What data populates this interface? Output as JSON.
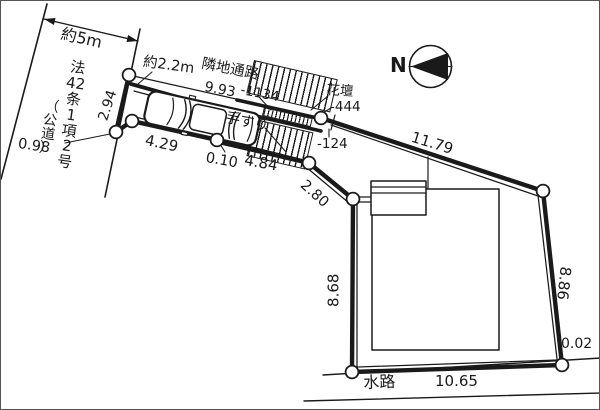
{
  "diagram": {
    "road": {
      "width_label": "約5m",
      "designation_main": "法\n42\n条\n1\n項\n2\n号",
      "designation_paren": "（\n公\n道\n）"
    },
    "passage": {
      "approach_width_label": "約2.2m",
      "neighbor_path_label": "隣地通路",
      "handrail_label": "手すり",
      "flower_bed_label": "花壇",
      "elevation_top": "-1134",
      "elevation_mid": "-444",
      "elevation_low": "-124"
    },
    "dims": {
      "neighbor_path_length": "9.93",
      "road_frontage": "2.94",
      "frontage_jog": "0.98",
      "passage_seg_1": "4.29",
      "passage_seg_2": "0.10",
      "passage_seg_3": "4.84",
      "connector": "2.80",
      "north_east_side": "11.79",
      "west_side": "8.68",
      "east_side": "8.86",
      "south_east_corner": "0.02",
      "south_side": "10.65"
    },
    "waterway_label": "水路",
    "compass_label": "N"
  }
}
